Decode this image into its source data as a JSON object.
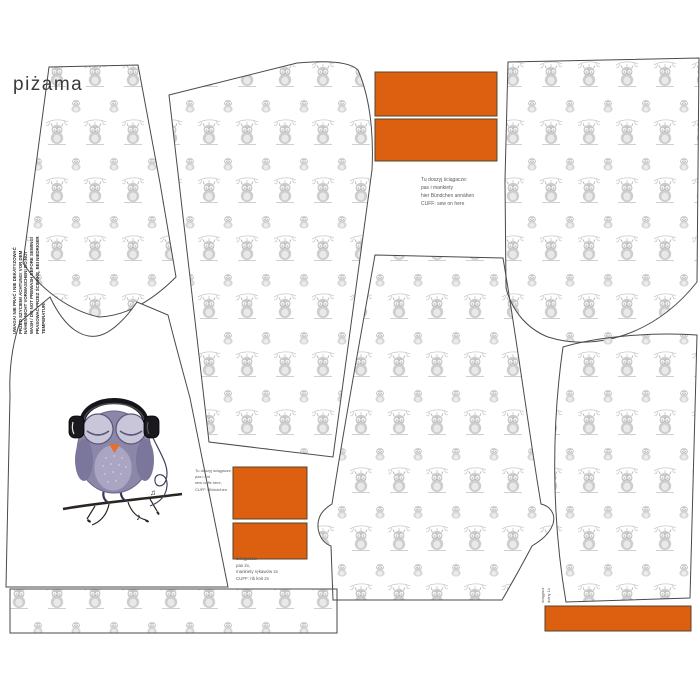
{
  "panel": {
    "label": "piżama"
  },
  "care_text": {
    "lines": [
      "UWAGA! NIE PRAĆ I NIE DEKATYZOWAĆ",
      "PRZED SZYCIEM! ACHTUNG! VOR DEM",
      "NÄHEN NICHT VORWASCHEN! DO NOT",
      "WASH / DO NOT PREWASH BEFORE SEWING!",
      "PRASOWAĆ PRZEZ ŚCIERKĘ, BEI NIEDRIGER",
      "TEMPERATUR!"
    ]
  },
  "notes": {
    "top": {
      "lines": [
        "Tu doszyj ściągacze:",
        "pas i mankiety",
        "hier Bündchen annähen",
        "CUFF: sew on here"
      ]
    },
    "mid": {
      "lines": [
        "Tu doszyj ściągacze,",
        "pas i dół",
        "sew cuffs here,",
        "CUFF / Bündchen"
      ]
    },
    "bottom": {
      "lines": [
        "Ściągacze:",
        "pas 2x,",
        "mankiety rękawów 2x",
        "CUFF: rib knit 2x"
      ]
    },
    "side": {
      "lines": [
        "ściągacz",
        "dolny 1x"
      ]
    }
  },
  "colors": {
    "accent_orange": "#dd5f10",
    "orange_border": "#5c4a2a",
    "pattern_gray": "#cdcdcd",
    "piece_outline": "#4a4a4a",
    "owl_body": "#8b87a8",
    "owl_wing": "#7b779c",
    "owl_belly": "#a9a5c2",
    "owl_eye": "#c9c6da",
    "owl_beak": "#e4702b",
    "headphones": "#1a1a1e",
    "branch": "#2a2520"
  }
}
